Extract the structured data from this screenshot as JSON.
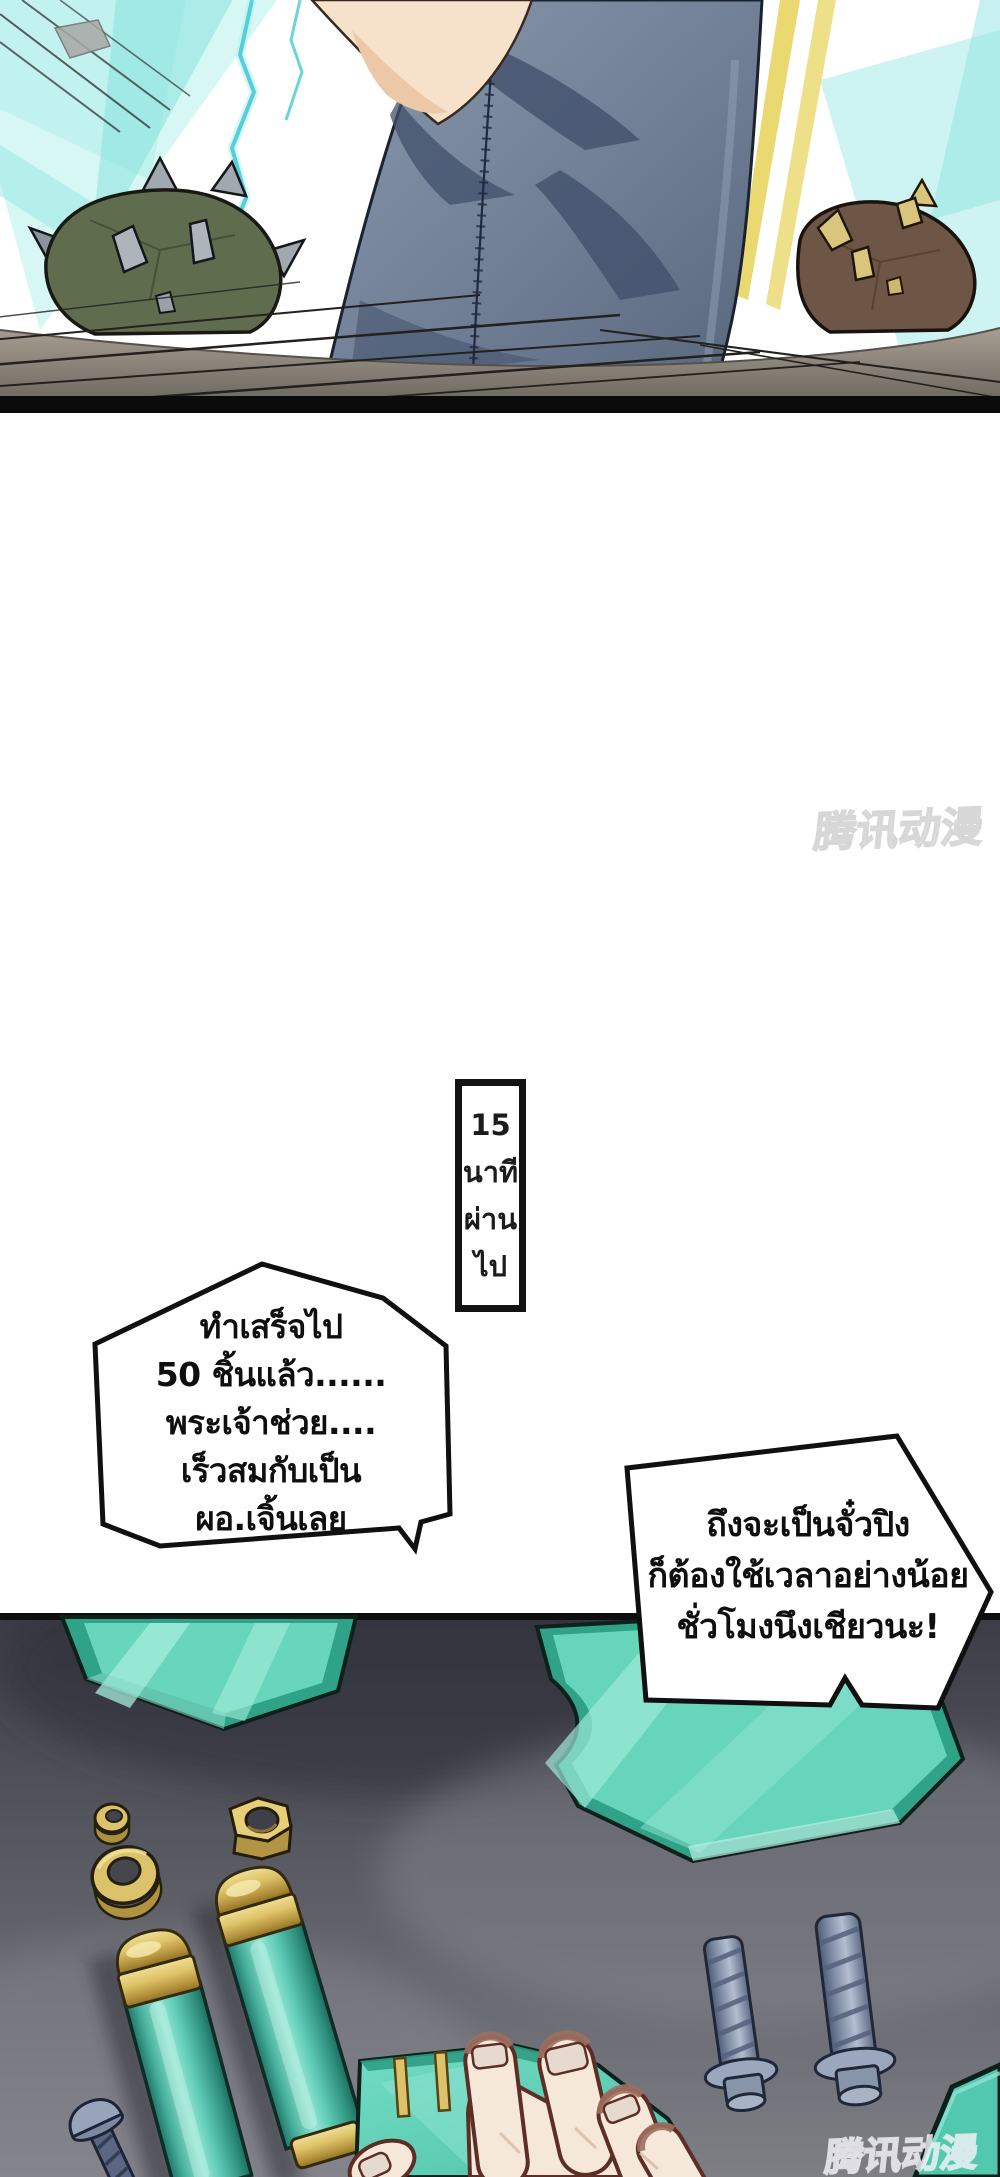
{
  "watermarks": {
    "top": "腾讯动漫",
    "bottom": "腾讯动漫"
  },
  "caption_box": {
    "lines": [
      "15",
      "นาที",
      "ผ่าน",
      "ไป"
    ]
  },
  "bubbles": {
    "left": {
      "lines": [
        "ทำเสร็จไป",
        "50 ชิ้นแล้ว......",
        "พระเจ้าช่วย....",
        "เร็วสมกับเป็น",
        "ผอ.เจิ้นเลย"
      ]
    },
    "right": {
      "lines": [
        "ถึงจะเป็นจั๋วปิง",
        "ก็ต้องใช้เวลาอย่างน้อย",
        "ชั่วโมงนึงเชียวนะ!"
      ]
    }
  },
  "palette": {
    "bubble_fill": "#ffffff",
    "outline_black": "#101010",
    "energy_cyan": "#7fdfdc",
    "beam_yellow": "#e8d562",
    "jacket_blue": "#6f7e95",
    "skin": "#f6e2cb",
    "mace_olive": "#5f6d4e",
    "mace_brown": "#6d5646",
    "ground_gray": "#a79e92",
    "panel_bg_dark": "#3c3c46",
    "panel_bg_light": "#7e7e85",
    "plate_teal": "#5fd2b8",
    "plate_teal_dark": "#2fa288",
    "brass_gold": "#dcc26b",
    "bolt_steel": "#8290a8",
    "hand_skin": "#f6e8d8",
    "hand_outline": "#5d2e26"
  }
}
